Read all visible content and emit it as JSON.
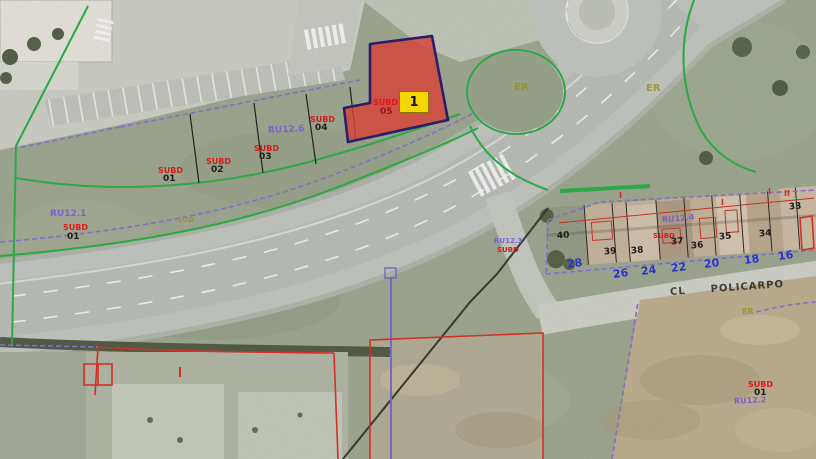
{
  "selected_parcel": {
    "badge": "1",
    "subd": "SUBD",
    "number": "05"
  },
  "left_parcel": {
    "zone": "RU12.1",
    "subd": "SUBD",
    "number": "01"
  },
  "parcel_strip": {
    "items": [
      {
        "subd": "SUBD",
        "number": "01"
      },
      {
        "subd": "SUBD",
        "number": "02"
      },
      {
        "subd": "SUBD",
        "number": "03"
      },
      {
        "subd": "SUBD",
        "number": "04"
      }
    ]
  },
  "zones": {
    "mid": "RU12.6",
    "island": {
      "zone": "RU12.3",
      "subd": "SUBD"
    },
    "er": [
      "ER",
      "ER",
      "ER"
    ],
    "sud": "SUD"
  },
  "buildings": {
    "zone": "RU12.4",
    "subd": "SUBD",
    "house_numbers": [
      "40",
      "39",
      "38",
      "37",
      "36",
      "35",
      "34",
      "33"
    ],
    "roman": [
      "I",
      "I",
      "I",
      "II"
    ]
  },
  "street": {
    "prefix": "CL",
    "name": "POLICARPO",
    "numbers": [
      "28",
      "26",
      "24",
      "22",
      "20",
      "18",
      "16"
    ]
  },
  "bottom_parcel": {
    "subd": "SUBD",
    "number": "01",
    "zone": "RU12.2"
  },
  "colors": {
    "selected_parcel_fill": "#e4483c",
    "selected_parcel_border": "#2b2171",
    "badge_bg": "#f6d600",
    "boundary_green": "#2fb44a",
    "boundary_purple": "#8a79d6",
    "cadastral_red": "#e01818",
    "street_number_blue": "#2b33cc",
    "zone_olive": "#9a9223"
  }
}
